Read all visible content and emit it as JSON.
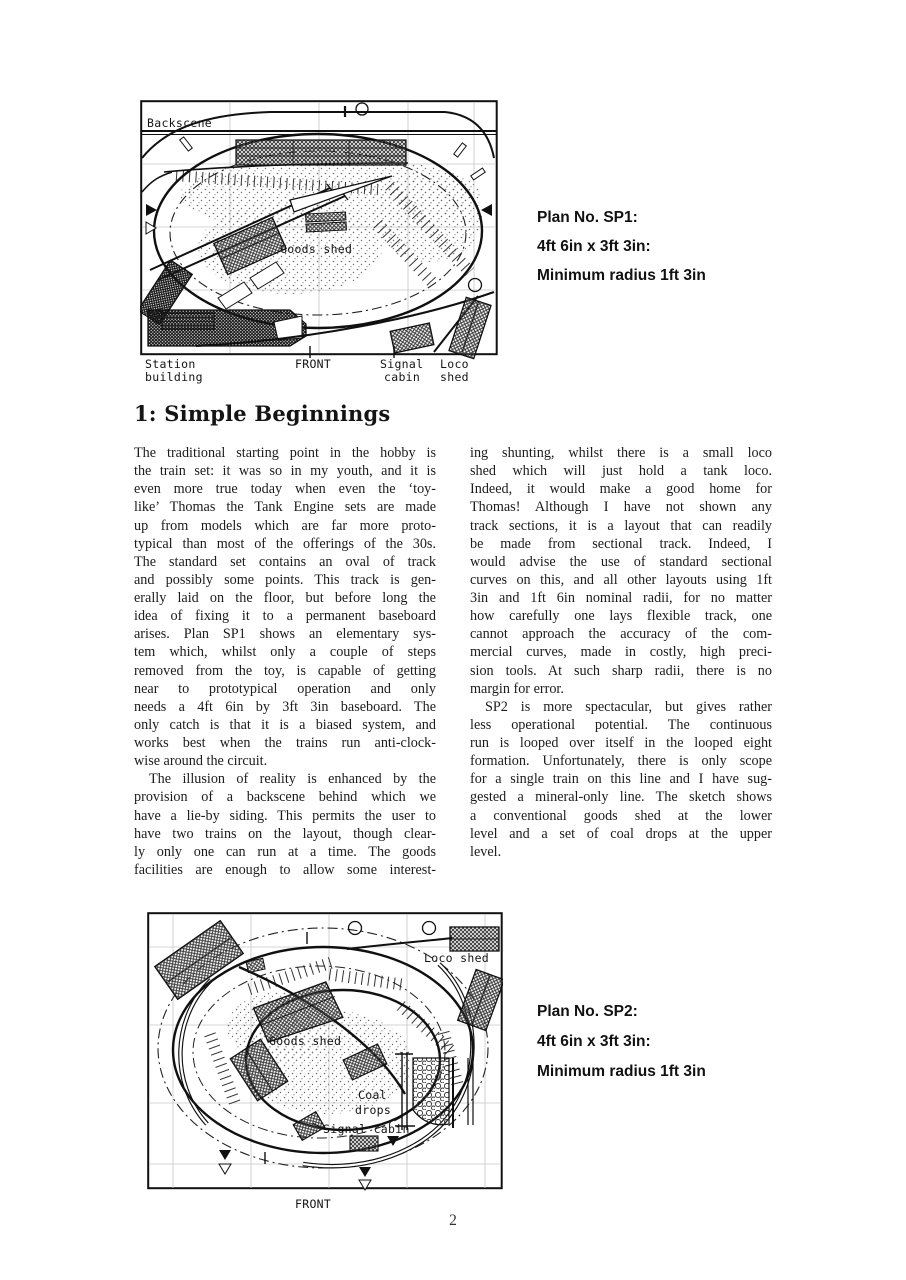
{
  "colors": {
    "paper": "#ffffff",
    "ink": "#1a1a1a"
  },
  "page": {
    "number": "2"
  },
  "section": {
    "heading": "1: Simple Beginnings"
  },
  "diagram_sp1": {
    "labels": {
      "backscene": "Backscene",
      "goods_shed": "Goods shed",
      "station_l1": "Station",
      "station_l2": "building",
      "front": "FRONT",
      "signal_l1": "Signal",
      "signal_l2": "cabin",
      "loco_l1": "Loco",
      "loco_l2": "shed"
    },
    "caption": {
      "line1": "Plan No. SP1:",
      "line2": "4ft 6in x 3ft 3in:",
      "line3": "Minimum radius 1ft 3in"
    }
  },
  "diagram_sp2": {
    "labels": {
      "loco_shed": "Loco shed",
      "goods_shed": "Goods shed",
      "coal_l1": "Coal",
      "coal_l2": "drops",
      "signal_cabin": "Signal cabin",
      "front": "FRONT"
    },
    "caption": {
      "line1": "Plan No. SP2:",
      "line2": "4ft 6in x 3ft 3in:",
      "line3": "Minimum radius 1ft 3in"
    }
  },
  "article": {
    "left_lines": [
      {
        "t": "The traditional starting point in the hobby is"
      },
      {
        "t": "the train set: it was so in my youth, and it is"
      },
      {
        "t": "even more true today when even the ‘toy-"
      },
      {
        "t": "like’ Thomas the Tank Engine sets are made"
      },
      {
        "t": "up from models which are far more proto-"
      },
      {
        "t": "typical than most of the offerings of the 30s."
      },
      {
        "t": "The standard set contains an oval of track"
      },
      {
        "t": "and possibly some points. This track is gen-"
      },
      {
        "t": "erally laid on the floor, but before long the"
      },
      {
        "t": "idea of fixing it to a permanent baseboard"
      },
      {
        "t": "arises. Plan SP1 shows an elementary sys-"
      },
      {
        "t": "tem which, whilst only a couple of steps"
      },
      {
        "t": "removed from the toy, is capable of getting"
      },
      {
        "t": "near to prototypical operation and only"
      },
      {
        "t": "needs a 4ft 6in by 3ft 3in baseboard. The"
      },
      {
        "t": "only catch is that it is a biased system, and"
      },
      {
        "t": "works best when the trains run anti-clock-"
      },
      {
        "t": "wise around the circuit.",
        "last": true
      },
      {
        "t": "The illusion of reality is enhanced by the",
        "indent": true
      },
      {
        "t": "provision of a backscene behind which we"
      },
      {
        "t": "have a lie-by siding. This permits the user to"
      },
      {
        "t": "have two trains on the layout, though clear-"
      },
      {
        "t": "ly only one can run at a time. The goods"
      },
      {
        "t": "facilities are enough to allow some interest-"
      }
    ],
    "right_lines": [
      {
        "t": "ing shunting, whilst there is a small loco"
      },
      {
        "t": "shed which will just hold a tank loco."
      },
      {
        "t": "Indeed, it would make a good home for"
      },
      {
        "t": "Thomas! Although I have not shown any"
      },
      {
        "t": "track sections, it is a layout that can readily"
      },
      {
        "t": "be made from sectional track. Indeed, I"
      },
      {
        "t": "would advise the use of standard sectional"
      },
      {
        "t": "curves on this, and all other layouts using 1ft"
      },
      {
        "t": "3in and 1ft 6in nominal radii, for no matter"
      },
      {
        "t": "how carefully one lays flexible track, one"
      },
      {
        "t": "cannot approach the accuracy of the com-"
      },
      {
        "t": "mercial curves, made in costly, high preci-"
      },
      {
        "t": "sion tools. At such sharp radii, there is no"
      },
      {
        "t": "margin for error.",
        "last": true
      },
      {
        "t": "SP2 is more spectacular, but gives rather",
        "indent": true
      },
      {
        "t": "less operational potential. The continuous"
      },
      {
        "t": "run is looped over itself in the looped eight"
      },
      {
        "t": "formation. Unfortunately, there is only scope"
      },
      {
        "t": "for a single train on this line and I have sug-"
      },
      {
        "t": "gested a mineral-only line. The sketch shows"
      },
      {
        "t": "a conventional goods shed at the lower"
      },
      {
        "t": "level and a set of coal drops at the upper"
      },
      {
        "t": "level.",
        "last": true
      }
    ]
  }
}
